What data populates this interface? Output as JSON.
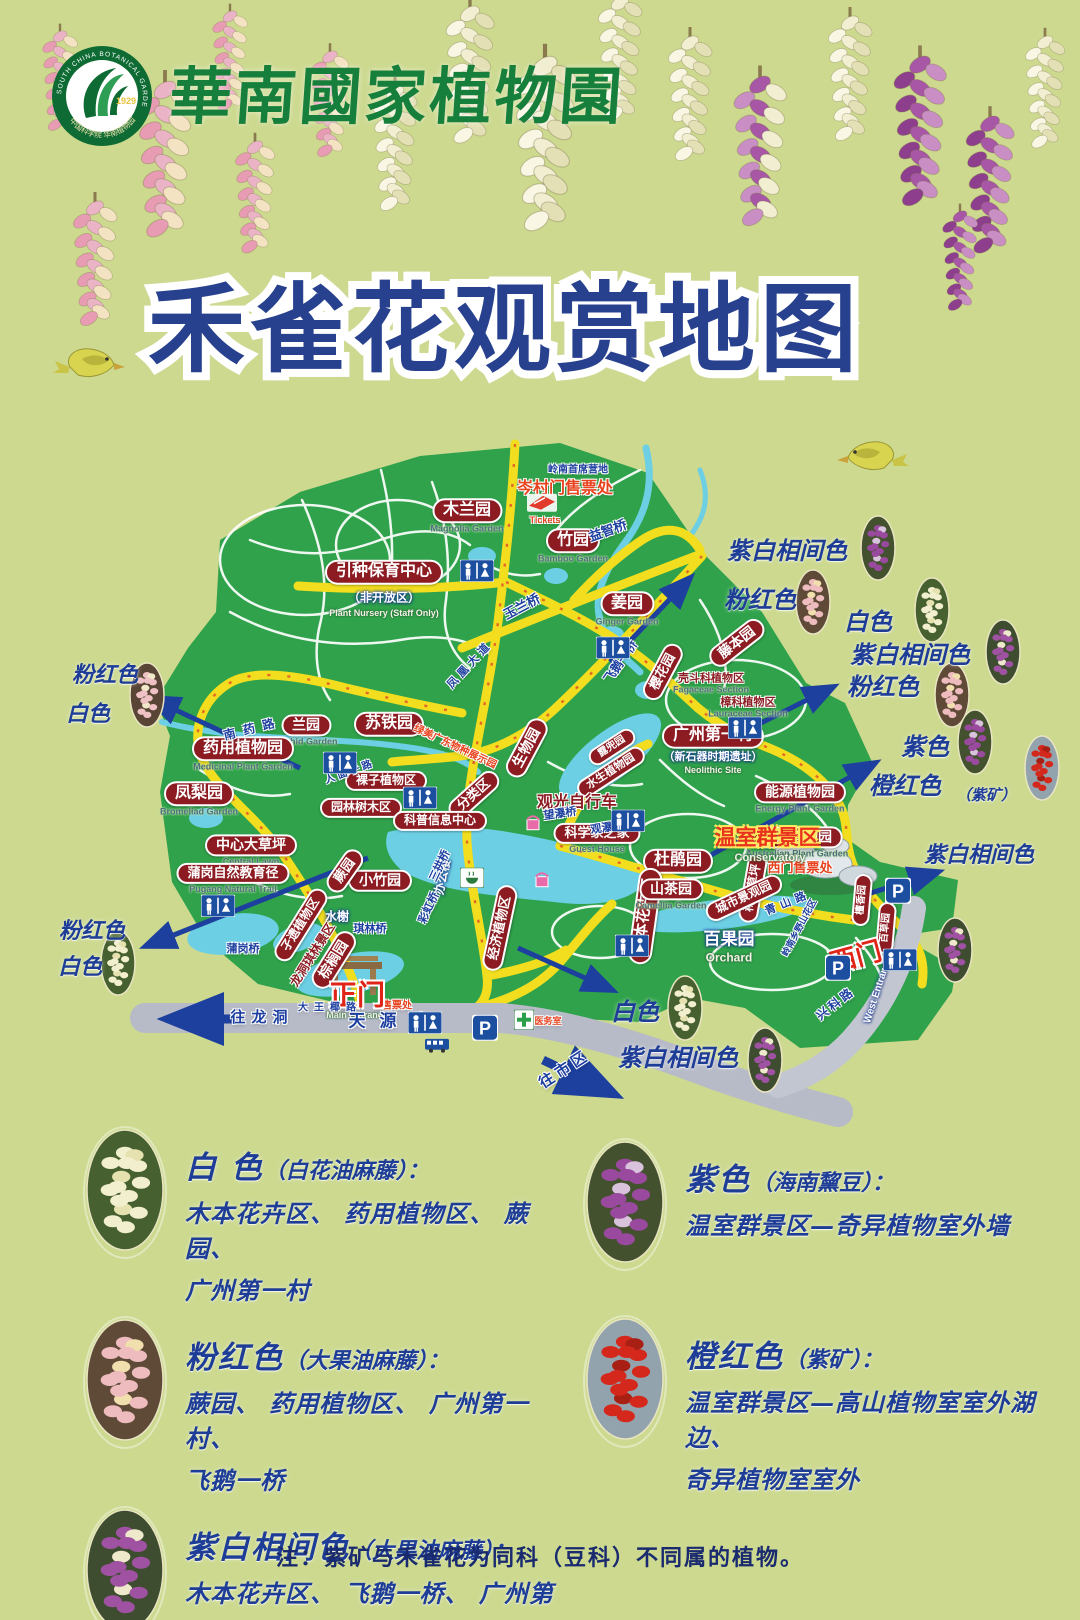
{
  "header": {
    "brand": "華南國家植物園",
    "logo": {
      "ring_text": "SOUTH CHINA BOTANICAL GARDEN",
      "year": "1929",
      "bottom_text": "中国科学院 华南植物园"
    }
  },
  "title": "禾雀花观赏地图",
  "colors": {
    "background": "#ccd98f",
    "park_green": "#2fa24b",
    "water_blue": "#6ccfe4",
    "road_yellow": "#f2de1e",
    "label_red": "#8c1c22",
    "title_blue": "#28418f",
    "annotation_blue": "#1e3d96",
    "gate_red": "#e02518",
    "brand_green": "#177f3c"
  },
  "map": {
    "labels": [
      {
        "t": "木兰园",
        "x": 467,
        "y": 516,
        "s": 16,
        "type": "pill",
        "en": "Magnolia Garden"
      },
      {
        "t": "竹园",
        "x": 573,
        "y": 546,
        "s": 16,
        "type": "pill",
        "en": "Bamboo Garden"
      },
      {
        "t": "姜园",
        "x": 627,
        "y": 609,
        "s": 16,
        "type": "pill",
        "en": "Ginger Garden"
      },
      {
        "t": "引种保育中心",
        "x": 384,
        "y": 572,
        "s": 16,
        "type": "pill"
      },
      {
        "t": "（非开放区）",
        "x": 384,
        "y": 598,
        "s": 12,
        "type": "white"
      },
      {
        "t": "Plant Nursery (Staff Only)",
        "x": 384,
        "y": 614,
        "s": 9,
        "type": "engw"
      },
      {
        "t": "藤本园",
        "x": 737,
        "y": 643,
        "s": 14,
        "type": "pill",
        "r": -38
      },
      {
        "t": "樱花园",
        "x": 663,
        "y": 672,
        "s": 13,
        "type": "pill",
        "r": -62
      },
      {
        "t": "壳斗科植物区",
        "x": 711,
        "y": 684,
        "s": 11,
        "type": "red",
        "en": "Fagaceae Section"
      },
      {
        "t": "樟科植物区",
        "x": 748,
        "y": 708,
        "s": 11,
        "type": "red",
        "en": "Lauraceae Section"
      },
      {
        "t": "广州第一村",
        "x": 713,
        "y": 736,
        "s": 16,
        "type": "pill"
      },
      {
        "t": "（新石器时期遗址）",
        "x": 713,
        "y": 757,
        "s": 11,
        "type": "white"
      },
      {
        "t": "Neolithic Site",
        "x": 713,
        "y": 771,
        "s": 9,
        "type": "engw"
      },
      {
        "t": "兰园",
        "x": 306,
        "y": 731,
        "s": 14,
        "type": "pill",
        "en": "Orchid Garden"
      },
      {
        "t": "苏铁园",
        "x": 389,
        "y": 724,
        "s": 16,
        "type": "pill"
      },
      {
        "t": "药用植物园",
        "x": 243,
        "y": 754,
        "s": 16,
        "type": "pill",
        "en": "Medicinal Plant Garden"
      },
      {
        "t": "凤梨园",
        "x": 199,
        "y": 799,
        "s": 16,
        "type": "pill",
        "en": "Bromeliad Garden"
      },
      {
        "t": "分类区",
        "x": 474,
        "y": 795,
        "s": 13,
        "type": "pill",
        "r": -42
      },
      {
        "t": "裸子植物区",
        "x": 386,
        "y": 781,
        "s": 12,
        "type": "pill"
      },
      {
        "t": "园林树木区",
        "x": 361,
        "y": 808,
        "s": 12,
        "type": "pill"
      },
      {
        "t": "科普信息中心",
        "x": 440,
        "y": 821,
        "s": 12,
        "type": "pill"
      },
      {
        "t": "生物园",
        "x": 527,
        "y": 748,
        "s": 14,
        "type": "pill",
        "r": -62
      },
      {
        "t": "露兜园",
        "x": 612,
        "y": 747,
        "s": 10,
        "type": "pill",
        "r": -33
      },
      {
        "t": "水生植物园",
        "x": 611,
        "y": 772,
        "s": 11,
        "type": "pill",
        "r": -33
      },
      {
        "t": "科学家之家",
        "x": 597,
        "y": 839,
        "s": 13,
        "type": "pill",
        "en": "Guest House"
      },
      {
        "t": "中心大草坪",
        "x": 251,
        "y": 851,
        "s": 14,
        "type": "pill",
        "en": "Central Lawn"
      },
      {
        "t": "小竹园",
        "x": 380,
        "y": 881,
        "s": 14,
        "type": "pill"
      },
      {
        "t": "蒲岗自然教育径",
        "x": 233,
        "y": 879,
        "s": 13,
        "type": "pill",
        "en": "Pugang Natural Trail"
      },
      {
        "t": "蕨园",
        "x": 345,
        "y": 871,
        "s": 13,
        "type": "pill",
        "r": -55
      },
      {
        "t": "杜鹃园",
        "x": 678,
        "y": 861,
        "s": 16,
        "type": "pill"
      },
      {
        "t": "稀树草坪",
        "x": 753,
        "y": 888,
        "s": 12,
        "type": "pill",
        "r": -80
      },
      {
        "t": "木本花卉区",
        "x": 645,
        "y": 916,
        "s": 15,
        "type": "pill",
        "r": -82
      },
      {
        "t": "经济植物区",
        "x": 500,
        "y": 928,
        "s": 13,
        "type": "pill",
        "r": -78
      },
      {
        "t": "山茶园",
        "x": 671,
        "y": 895,
        "s": 14,
        "type": "pill",
        "en": "Camellia Garden"
      },
      {
        "t": "城市景观园",
        "x": 744,
        "y": 898,
        "s": 12,
        "type": "pill",
        "r": -25
      },
      {
        "t": "能源植物园",
        "x": 800,
        "y": 798,
        "s": 14,
        "type": "pill",
        "en": "Energy Plant Garden"
      },
      {
        "t": "澳洲植物园",
        "x": 797,
        "y": 843,
        "s": 14,
        "type": "pill",
        "en": "Australian Plant Garden"
      },
      {
        "t": "孑遗植物区",
        "x": 301,
        "y": 925,
        "s": 12,
        "type": "pill",
        "r": -58
      },
      {
        "t": "棕榈园",
        "x": 334,
        "y": 960,
        "s": 14,
        "type": "pill",
        "r": -58
      },
      {
        "t": "檀香园",
        "x": 862,
        "y": 900,
        "s": 10,
        "type": "pill",
        "r": -85
      },
      {
        "t": "百草园",
        "x": 886,
        "y": 928,
        "s": 10,
        "type": "pill",
        "r": -85
      },
      {
        "t": "办公楼",
        "x": 443,
        "y": 877,
        "s": 12,
        "type": "white",
        "r": -78
      },
      {
        "t": "水榭",
        "x": 337,
        "y": 917,
        "s": 12,
        "type": "white"
      },
      {
        "t": "百果园",
        "x": 729,
        "y": 940,
        "s": 17,
        "type": "white"
      },
      {
        "t": "Orchard",
        "x": 729,
        "y": 958,
        "s": 12,
        "type": "engw"
      },
      {
        "t": "观光自行车",
        "x": 577,
        "y": 803,
        "s": 16,
        "type": "red"
      },
      {
        "t": "龙洞琪林景区",
        "x": 313,
        "y": 955,
        "s": 12,
        "type": "red",
        "r": -58
      },
      {
        "t": "绿美广东物种展示园",
        "x": 455,
        "y": 747,
        "s": 10,
        "type": "orange",
        "r": 25
      },
      {
        "t": "岑村门售票处",
        "x": 565,
        "y": 489,
        "s": 16,
        "type": "orange"
      },
      {
        "t": "Tickets",
        "x": 545,
        "y": 521,
        "s": 9,
        "type": "orange"
      },
      {
        "t": "西门售票处",
        "x": 800,
        "y": 868,
        "s": 13,
        "type": "orange"
      },
      {
        "t": "温室群景区",
        "x": 767,
        "y": 838,
        "s": 21,
        "type": "cons"
      },
      {
        "t": "Conservatory",
        "x": 770,
        "y": 858,
        "s": 11,
        "type": "engw"
      },
      {
        "t": "售票处",
        "x": 397,
        "y": 1006,
        "s": 10,
        "type": "orange"
      },
      {
        "t": "医务室",
        "x": 548,
        "y": 1022,
        "s": 9,
        "type": "orange"
      },
      {
        "t": "正门",
        "x": 357,
        "y": 996,
        "s": 28,
        "type": "gate"
      },
      {
        "t": "Main Entrance",
        "x": 357,
        "y": 1016,
        "s": 9,
        "type": "engw"
      },
      {
        "t": "西门",
        "x": 856,
        "y": 957,
        "s": 26,
        "type": "gate",
        "r": -15
      },
      {
        "t": "West Entrance",
        "x": 878,
        "y": 990,
        "s": 10,
        "type": "white",
        "r": -72
      },
      {
        "t": "岭南首席营地",
        "x": 578,
        "y": 470,
        "s": 10,
        "type": "blue"
      },
      {
        "t": "益智桥",
        "x": 608,
        "y": 531,
        "s": 13,
        "type": "blue",
        "r": -20
      },
      {
        "t": "玉兰桥",
        "x": 522,
        "y": 607,
        "s": 13,
        "type": "blue",
        "r": -28
      },
      {
        "t": "凤凰大道",
        "x": 470,
        "y": 665,
        "s": 11,
        "type": "blue",
        "r": -47,
        "ls": 4
      },
      {
        "t": "人面子路",
        "x": 350,
        "y": 772,
        "s": 10,
        "type": "blue",
        "r": -20,
        "ls": 3
      },
      {
        "t": "飞鹅一桥",
        "x": 621,
        "y": 662,
        "s": 12,
        "type": "blue",
        "r": -55
      },
      {
        "t": "望瀑桥",
        "x": 560,
        "y": 814,
        "s": 11,
        "type": "blue",
        "r": -8
      },
      {
        "t": "观瀑桥",
        "x": 607,
        "y": 828,
        "s": 11,
        "type": "blue",
        "r": -8
      },
      {
        "t": "三拱桥",
        "x": 440,
        "y": 866,
        "s": 11,
        "type": "blue",
        "r": -65
      },
      {
        "t": "彩虹桥",
        "x": 429,
        "y": 908,
        "s": 11,
        "type": "blue",
        "r": -65
      },
      {
        "t": "琪林桥",
        "x": 370,
        "y": 929,
        "s": 11,
        "type": "blue"
      },
      {
        "t": "蒲岗桥",
        "x": 243,
        "y": 949,
        "s": 11,
        "type": "blue"
      },
      {
        "t": "南药路",
        "x": 253,
        "y": 729,
        "s": 12,
        "type": "blue",
        "r": -14,
        "ls": 8
      },
      {
        "t": "青山路",
        "x": 788,
        "y": 903,
        "s": 11,
        "type": "blue",
        "r": -22,
        "ls": 5
      },
      {
        "t": "岭南乡野山花区",
        "x": 800,
        "y": 928,
        "s": 9,
        "type": "blue",
        "r": -62
      },
      {
        "t": "兴科路",
        "x": 836,
        "y": 1004,
        "s": 12,
        "type": "blue",
        "r": -38,
        "ls": 3
      },
      {
        "t": "天源路",
        "x": 395,
        "y": 1022,
        "s": 17,
        "type": "blue",
        "ls": 14
      },
      {
        "t": "往龙洞",
        "x": 262,
        "y": 1018,
        "s": 15,
        "type": "blue",
        "ls": 6
      },
      {
        "t": "往市区",
        "x": 565,
        "y": 1070,
        "s": 15,
        "type": "blue",
        "r": -33,
        "ls": 4
      },
      {
        "t": "大王椰路",
        "x": 330,
        "y": 1008,
        "s": 10,
        "type": "blue",
        "ls": 6
      },
      {
        "t": "紫白相间色",
        "x": 787,
        "y": 551,
        "s": 24,
        "type": "note"
      },
      {
        "t": "粉红色",
        "x": 760,
        "y": 600,
        "s": 24,
        "type": "note"
      },
      {
        "t": "白色",
        "x": 868,
        "y": 622,
        "s": 24,
        "type": "note"
      },
      {
        "t": "紫白相间色",
        "x": 910,
        "y": 655,
        "s": 24,
        "type": "note"
      },
      {
        "t": "粉红色",
        "x": 883,
        "y": 687,
        "s": 24,
        "type": "note"
      },
      {
        "t": "紫色",
        "x": 925,
        "y": 747,
        "s": 24,
        "type": "note"
      },
      {
        "t": "橙红色",
        "x": 905,
        "y": 786,
        "s": 24,
        "type": "note"
      },
      {
        "t": "（紫矿）",
        "x": 986,
        "y": 795,
        "s": 15,
        "type": "note"
      },
      {
        "t": "紫白相间色",
        "x": 979,
        "y": 855,
        "s": 22,
        "type": "note"
      },
      {
        "t": "粉红色",
        "x": 105,
        "y": 675,
        "s": 22,
        "type": "note"
      },
      {
        "t": "白色",
        "x": 88,
        "y": 714,
        "s": 22,
        "type": "note"
      },
      {
        "t": "粉红色",
        "x": 92,
        "y": 931,
        "s": 22,
        "type": "note"
      },
      {
        "t": "白色",
        "x": 80,
        "y": 967,
        "s": 22,
        "type": "note"
      },
      {
        "t": "白色",
        "x": 635,
        "y": 1012,
        "s": 24,
        "type": "note"
      },
      {
        "t": "紫白相间色",
        "x": 678,
        "y": 1058,
        "s": 24,
        "type": "note"
      }
    ],
    "arrows": [
      {
        "x1": 300,
        "y1": 768,
        "x2": 150,
        "y2": 698
      },
      {
        "x1": 368,
        "y1": 858,
        "x2": 146,
        "y2": 946
      },
      {
        "x1": 610,
        "y1": 662,
        "x2": 690,
        "y2": 578
      },
      {
        "x1": 733,
        "y1": 737,
        "x2": 833,
        "y2": 687
      },
      {
        "x1": 688,
        "y1": 868,
        "x2": 875,
        "y2": 763
      },
      {
        "x1": 518,
        "y1": 948,
        "x2": 612,
        "y2": 990
      },
      {
        "x1": 858,
        "y1": 897,
        "x2": 938,
        "y2": 872
      },
      {
        "x1": 235,
        "y1": 1019,
        "x2": 170,
        "y2": 1019,
        "w": 9
      },
      {
        "x1": 543,
        "y1": 1060,
        "x2": 612,
        "y2": 1093,
        "w": 9
      }
    ],
    "spots": [
      {
        "x": 878,
        "y": 548,
        "v": "purple"
      },
      {
        "x": 813,
        "y": 602,
        "v": "pink"
      },
      {
        "x": 932,
        "y": 610,
        "v": "white"
      },
      {
        "x": 1003,
        "y": 652,
        "v": "purplewhite"
      },
      {
        "x": 952,
        "y": 695,
        "v": "pink"
      },
      {
        "x": 975,
        "y": 742,
        "v": "purple"
      },
      {
        "x": 1042,
        "y": 768,
        "v": "red"
      },
      {
        "x": 955,
        "y": 950,
        "v": "purplewhite"
      },
      {
        "x": 147,
        "y": 695,
        "v": "pinkwhite"
      },
      {
        "x": 118,
        "y": 963,
        "v": "white"
      },
      {
        "x": 685,
        "y": 1008,
        "v": "white"
      },
      {
        "x": 765,
        "y": 1060,
        "v": "purplewhite"
      }
    ],
    "icons": [
      {
        "type": "toilet",
        "x": 477,
        "y": 573
      },
      {
        "type": "toilet",
        "x": 613,
        "y": 650
      },
      {
        "type": "toilet",
        "x": 340,
        "y": 765
      },
      {
        "type": "toilet",
        "x": 420,
        "y": 800
      },
      {
        "type": "toilet",
        "x": 628,
        "y": 823
      },
      {
        "type": "toilet",
        "x": 745,
        "y": 730
      },
      {
        "type": "toilet",
        "x": 218,
        "y": 908
      },
      {
        "type": "toilet",
        "x": 632,
        "y": 948
      },
      {
        "type": "toilet",
        "x": 900,
        "y": 962
      },
      {
        "type": "toilet",
        "x": 425,
        "y": 1025
      },
      {
        "type": "parking",
        "x": 898,
        "y": 893
      },
      {
        "type": "parking",
        "x": 838,
        "y": 970
      },
      {
        "type": "parking",
        "x": 485,
        "y": 1030
      },
      {
        "type": "bus",
        "x": 437,
        "y": 1048
      },
      {
        "type": "tea",
        "x": 472,
        "y": 880
      },
      {
        "type": "clinic",
        "x": 524,
        "y": 1022
      },
      {
        "type": "ticket",
        "x": 542,
        "y": 505
      },
      {
        "type": "shop",
        "x": 533,
        "y": 825
      },
      {
        "type": "shop",
        "x": 542,
        "y": 882
      }
    ]
  },
  "legend": {
    "left": [
      {
        "color": "白 色",
        "species": "（白花油麻藤）：",
        "lines": [
          "木本花卉区、 药用植物区、 蕨园、",
          "广州第一村"
        ],
        "variant": "white"
      },
      {
        "color": "粉红色",
        "species": "（大果油麻藤）：",
        "lines": [
          "蕨园、 药用植物区、 广州第一村、",
          "飞鹅一桥"
        ],
        "variant": "pink"
      },
      {
        "color": "紫白相间色",
        "species": "（大果油麻藤）：",
        "lines": [
          "木本花卉区、 飞鹅一桥、 广州第",
          "一村、 西门停车场"
        ],
        "variant": "purplewhite"
      }
    ],
    "right": [
      {
        "color": "紫色",
        "species": "（海南黧豆）：",
        "lines": [
          "温室群景区—奇异植物室外墙"
        ],
        "variant": "purple"
      },
      {
        "color": "橙红色",
        "species": "（紫矿）：",
        "lines": [
          "温室群景区—高山植物室室外湖边、",
          "奇异植物室室外"
        ],
        "variant": "red"
      }
    ]
  },
  "note": "注：紫矿与禾雀花为同科（豆科）不同属的植物。"
}
